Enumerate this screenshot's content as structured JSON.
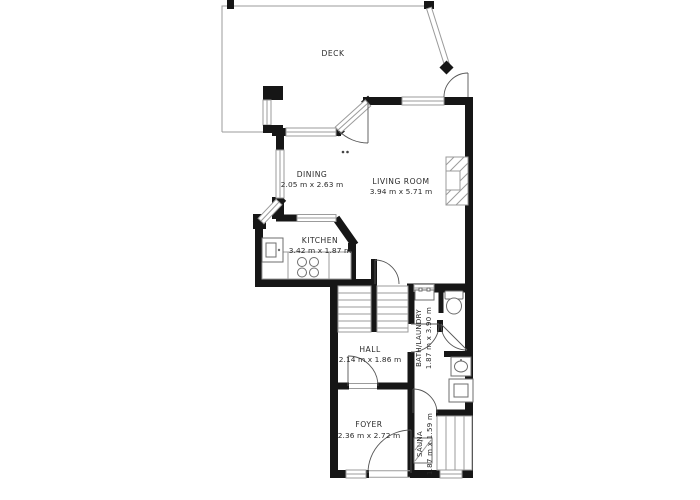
{
  "plan": {
    "deck": {
      "name": "DECK"
    },
    "dining": {
      "name": "DINING",
      "dims": "2.05 m x 2.63 m"
    },
    "living_room": {
      "name": "LIVING ROOM",
      "dims": "3.94 m x 5.71 m"
    },
    "kitchen": {
      "name": "KITCHEN",
      "dims": "3.42 m x 1.87 m"
    },
    "hall": {
      "name": "HALL",
      "dims": "2.14 m x 1.86 m"
    },
    "foyer": {
      "name": "FOYER",
      "dims": "2.36 m x 2.72 m"
    },
    "bath_laundry": {
      "name": "BATH/LAUNDRY",
      "dims": "1.87 m x 3.90 m"
    },
    "sauna": {
      "name": "SAUNA",
      "dims": "1.87 m x 1.59 m"
    }
  },
  "colors": {
    "wall": "#161616",
    "thin_line": "#9b9b9b",
    "fixture": "#6e6e6e",
    "text": "#2a2a2a",
    "background": "#ffffff"
  }
}
